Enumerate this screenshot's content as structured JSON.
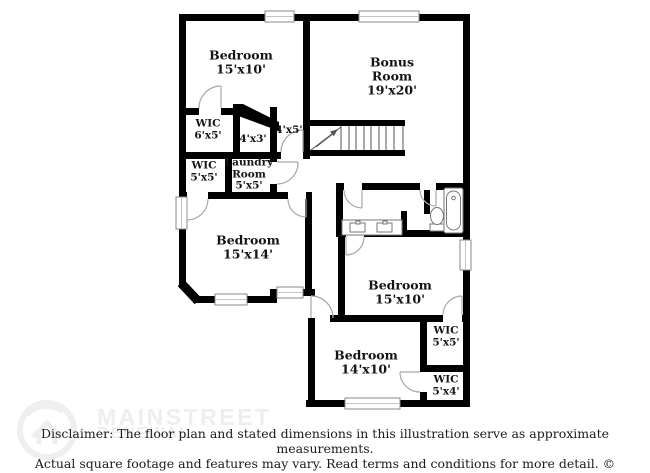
{
  "floorplan": {
    "rooms": [
      {
        "id": "bedroom-top-left",
        "name": "Bedroom",
        "dims": "15'x10'"
      },
      {
        "id": "bonus-room",
        "name": "Bonus Room",
        "dims": "19'x20'"
      },
      {
        "id": "wic-6x5",
        "name": "WIC",
        "dims": "6'x5'"
      },
      {
        "id": "closet-4x3",
        "name": "",
        "dims": "4'x3'"
      },
      {
        "id": "hall-4x5",
        "name": "",
        "dims": "4'x5'"
      },
      {
        "id": "wic-5x5-left",
        "name": "WIC",
        "dims": "5'x5'"
      },
      {
        "id": "laundry-room",
        "name": "Laundry Room",
        "dims": "5'x5'"
      },
      {
        "id": "bedroom-15x14",
        "name": "Bedroom",
        "dims": "15'x14'"
      },
      {
        "id": "bedroom-15x10-right",
        "name": "Bedroom",
        "dims": "15'x10'"
      },
      {
        "id": "wic-5x5-right",
        "name": "WIC",
        "dims": "5'x5'"
      },
      {
        "id": "bedroom-14x10",
        "name": "Bedroom",
        "dims": "14'x10'"
      },
      {
        "id": "wic-5x4",
        "name": "WIC",
        "dims": "5'x4'"
      }
    ]
  },
  "watermark": {
    "brand_line1": "MAINSTREET",
    "brand_line2": "RENEWAL",
    "logo": "mainstreet-renewal-logo"
  },
  "disclaimer": {
    "line1": "Disclaimer: The floor plan and stated dimensions in this illustration serve as approximate measurements.",
    "line2": "Actual square footage and features may vary. Read terms and conditions for more detail. © PlanOmatic"
  },
  "colors": {
    "wall": "#000000",
    "background": "#ffffff",
    "watermark": "#eeeeee",
    "text": "#141414"
  }
}
